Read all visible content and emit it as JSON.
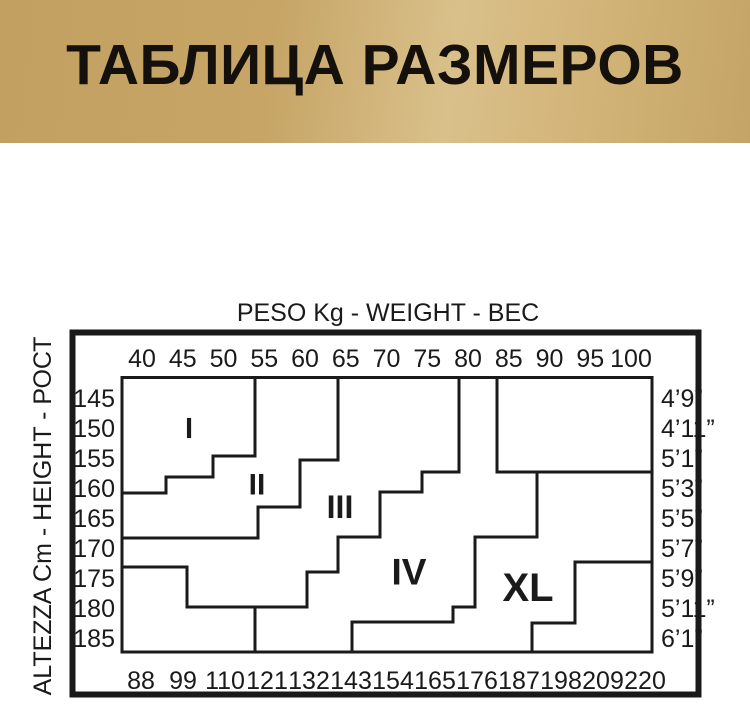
{
  "banner": {
    "title": "ТАБЛИЦА РАЗМЕРОВ",
    "bg_colors": [
      "#c2a061",
      "#d9c08a",
      "#c5a567"
    ]
  },
  "chart_data": {
    "type": "table",
    "description": "Hosiery size chart: height (rows) vs weight (columns) mapped to size regions I, II, III, IV, XL separated by stepped boundary lines",
    "line_color": "#1a1a1a",
    "top_axis": {
      "title": "PESO Kg - WEIGHT - ВЕС",
      "unit": "kg",
      "ticks": [
        "40",
        "45",
        "50",
        "55",
        "60",
        "65",
        "70",
        "75",
        "80",
        "85",
        "90",
        "95",
        "100"
      ]
    },
    "bottom_axis": {
      "unit": "lb",
      "ticks": [
        "88",
        "99",
        "110",
        "121",
        "132",
        "143",
        "154",
        "165",
        "176",
        "187",
        "198",
        "209",
        "220"
      ]
    },
    "left_axis": {
      "title": "ALTEZZA Cm - HEIGHT - РОСТ",
      "unit": "cm",
      "ticks": [
        "145",
        "150",
        "155",
        "160",
        "165",
        "170",
        "175",
        "180",
        "185"
      ]
    },
    "right_axis": {
      "unit": "feet-inches",
      "ticks": [
        "4’9”",
        "4’11”",
        "5’1”",
        "5’3”",
        "5’5”",
        "5’7”",
        "5’9”",
        "5’11”",
        "6’1”"
      ]
    },
    "regions": [
      {
        "label": "I",
        "x": 189,
        "y": 429,
        "font": 29
      },
      {
        "label": "II",
        "x": 257,
        "y": 485,
        "font": 30
      },
      {
        "label": "III",
        "x": 340,
        "y": 507,
        "font": 32
      },
      {
        "label": "IV",
        "x": 409,
        "y": 572,
        "font": 37
      },
      {
        "label": "XL",
        "x": 528,
        "y": 588,
        "font": 40
      }
    ],
    "boundaries": [
      {
        "name": "boundary-size-1-2",
        "points": "255,377.5 255,456 213,456 213,477 166,477 166,493 120.5,493"
      },
      {
        "name": "boundary-size-2-3",
        "points": "338,377.5 338,460 300,460 300,507 258,507 258,538 120.5,538"
      },
      {
        "name": "boundary-size-3-4",
        "points": "459,377.5 459,472 422,472 422,492 380,492 380,537 338,537 338,572 307,572 307,607 187,607 187,567 120.5,567"
      },
      {
        "name": "boundary-size-3-4-drop",
        "points": "255,607 255,652"
      },
      {
        "name": "boundary-top-right-box",
        "points": "497,377.5 497,472 652,472"
      },
      {
        "name": "boundary-size-4-xl",
        "points": "537,472 537,537 475,537 475,607 453,607 453,622 352,622 352,653"
      },
      {
        "name": "boundary-xl-lower-right",
        "points": "653,562 575,562 575,623 532,623 532,653"
      }
    ],
    "frame": {
      "outer": {
        "x": 72.5,
        "y": 332.5,
        "w": 626,
        "h": 362,
        "stroke": 6
      },
      "inner": {
        "x": 122,
        "y": 377.5,
        "w": 530,
        "h": 274.5,
        "stroke": 3
      }
    },
    "axis_layout": {
      "top_ticks": {
        "x0": 142,
        "dx": 40.75,
        "y": 367
      },
      "bottom_ticks": {
        "x0": 141,
        "dx": 42,
        "y": 689
      },
      "left_ticks": {
        "x": 115,
        "y0": 398,
        "dy": 30
      },
      "right_ticks": {
        "x": 661,
        "y0": 398,
        "dy": 30
      }
    }
  }
}
